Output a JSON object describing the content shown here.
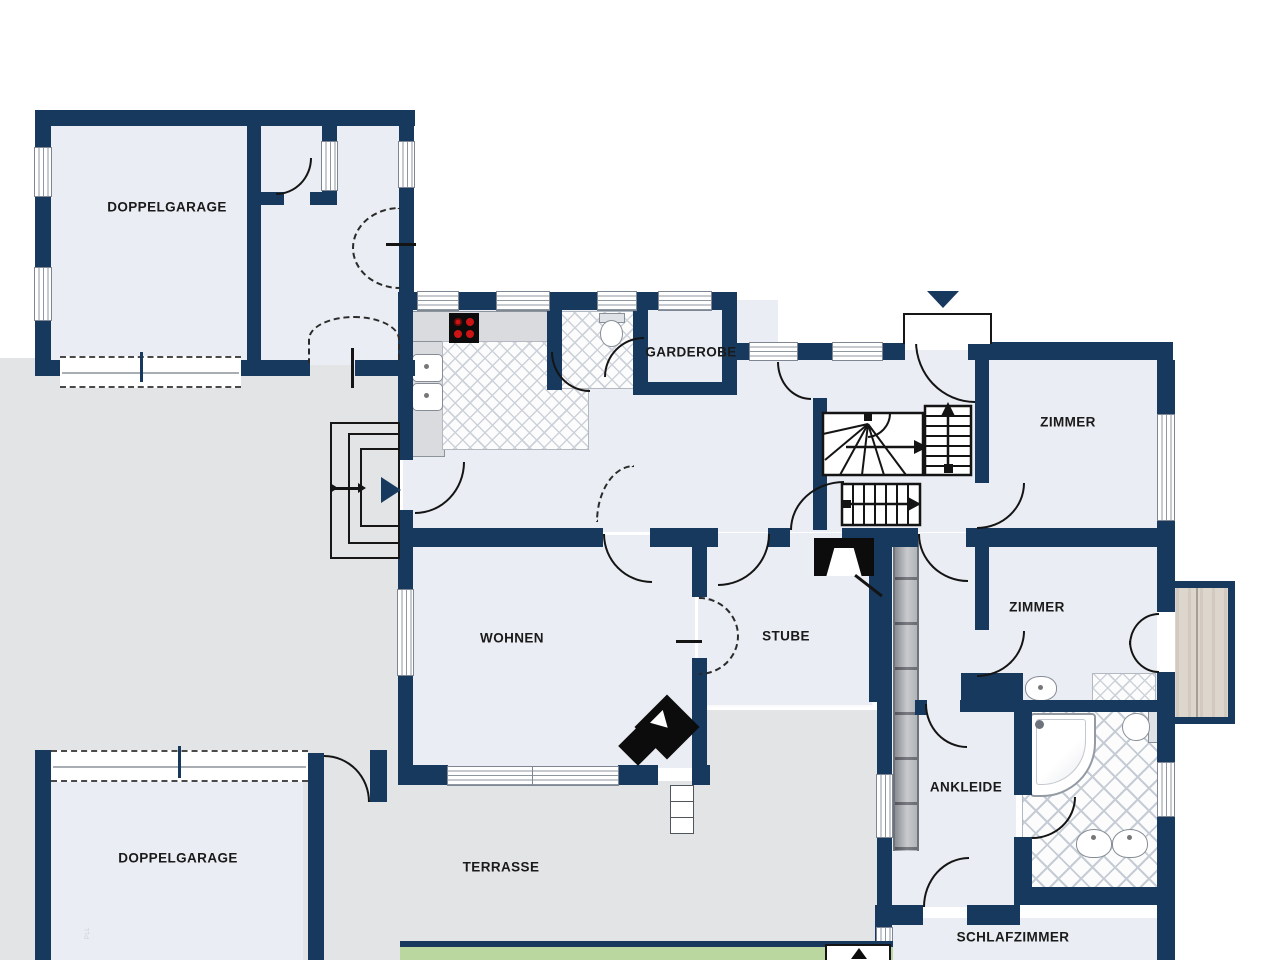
{
  "rooms": {
    "garage_top": "DOPPELGARAGE",
    "garderobe": "GARDEROBE",
    "zimmer_top": "ZIMMER",
    "wohnen": "WOHNEN",
    "stube": "STUBE",
    "zimmer_mid": "ZIMMER",
    "ankleide": "ANKLEIDE",
    "garage_bottom": "DOPPELGARAGE",
    "terrasse": "TERRASSE",
    "schlafzimmer": "SCHLAFZIMMER"
  },
  "watermark": "PLL",
  "colors": {
    "wall": "#17395e",
    "room_floor": "#eaedf3",
    "outdoor": "#e3e4e6",
    "lawn": "#b9d79e",
    "wood_deck": "#d8d1c8",
    "tile_line": "#ccd2da",
    "burner_red": "#cc1414",
    "icon_black": "#0c0c0c"
  },
  "icons": {
    "entrance_top": "chevron-down-icon",
    "entrance_west": "triangle-right-icon",
    "stairs": "direction-arrow-icon"
  }
}
